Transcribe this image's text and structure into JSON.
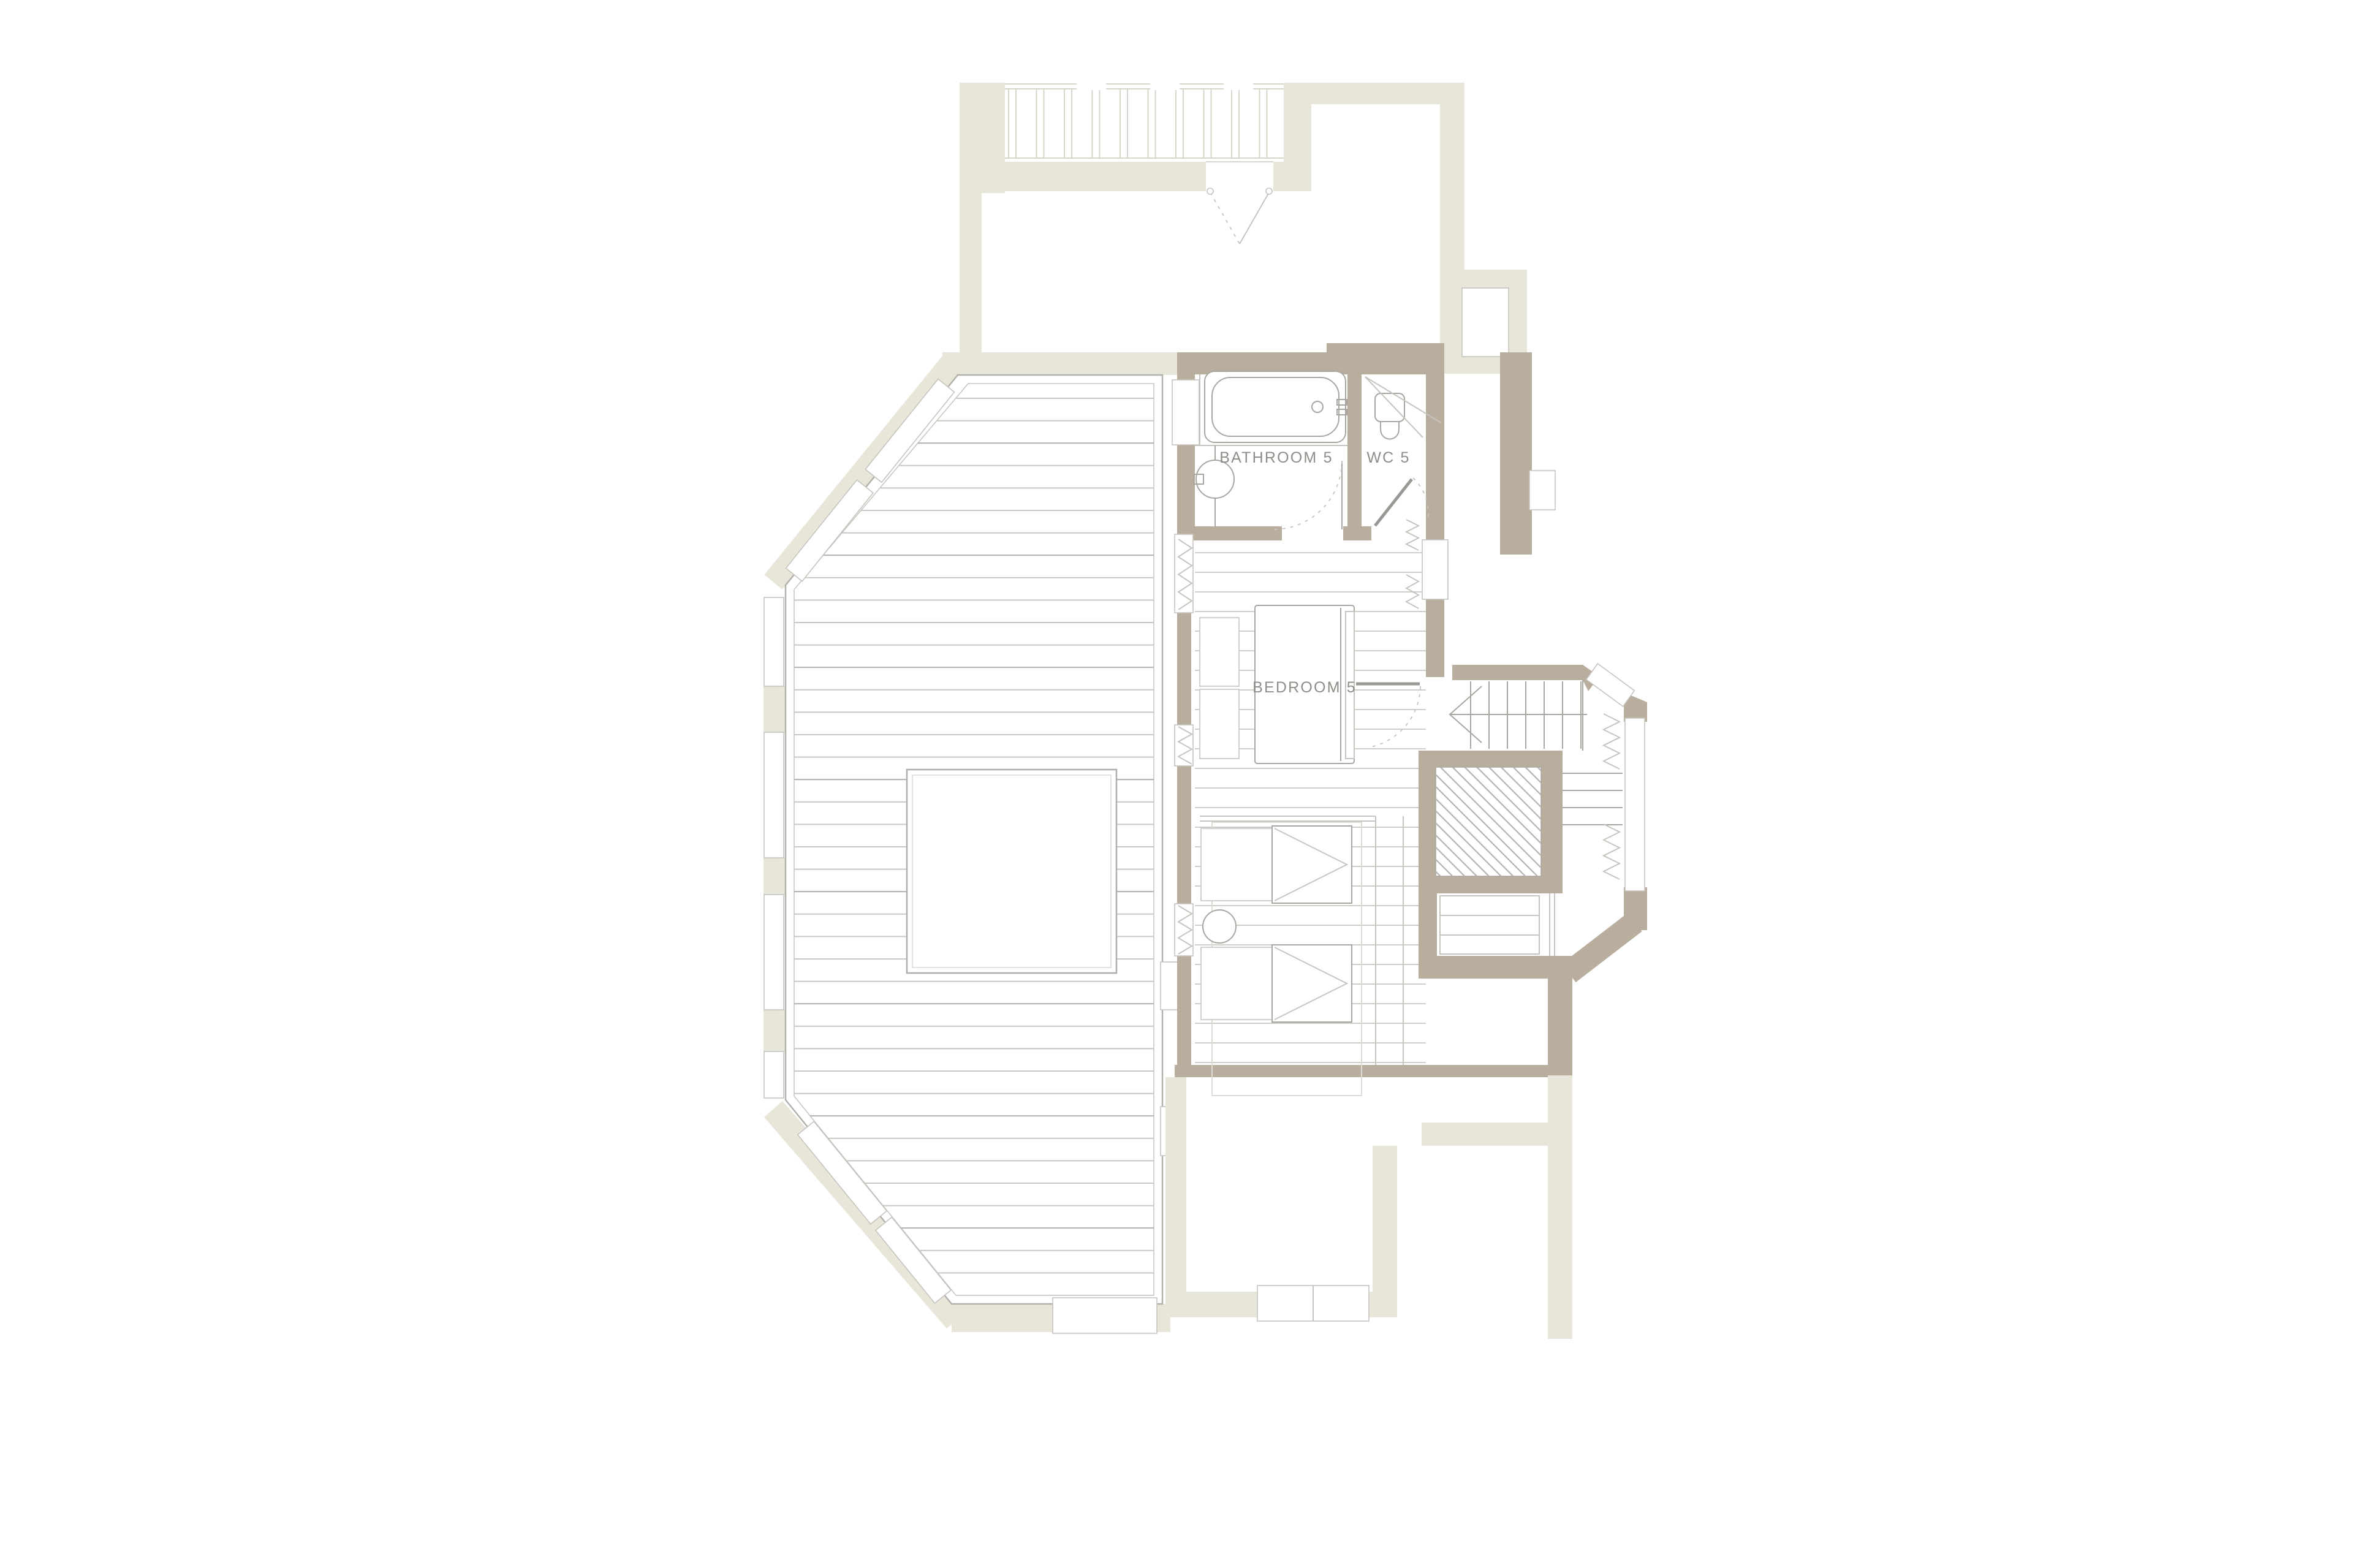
{
  "meta": {
    "type": "architectural-floor-plan",
    "floor_label_suffix": "5"
  },
  "colors": {
    "background": "#ffffff",
    "wall": "#b9ae9e",
    "ghost": "#e8e5d9",
    "ghost_line": "#d8d5c9",
    "line": "#a8a6a1",
    "line_light": "#c6c4bf",
    "plank": "#d0cec9",
    "deck_plank": "#c9c7c2",
    "hatch": "#b4b2ad",
    "text": "#8f8d88"
  },
  "rooms": {
    "bathroom": {
      "label": "BATHROOM 5"
    },
    "wc": {
      "label": "WC 5"
    },
    "bedroom": {
      "label": "BEDROOM 5"
    }
  },
  "features": [
    "roof-deck with plank decking and skylight",
    "bathtub",
    "washbasin",
    "toilet",
    "double bed",
    "bedside cabinets",
    "wardrobes with hanging rails",
    "two twin beds with round side table",
    "staircase with down arrow",
    "hatched void shaft",
    "bay window with radiators",
    "ghosted lower-level structure"
  ]
}
